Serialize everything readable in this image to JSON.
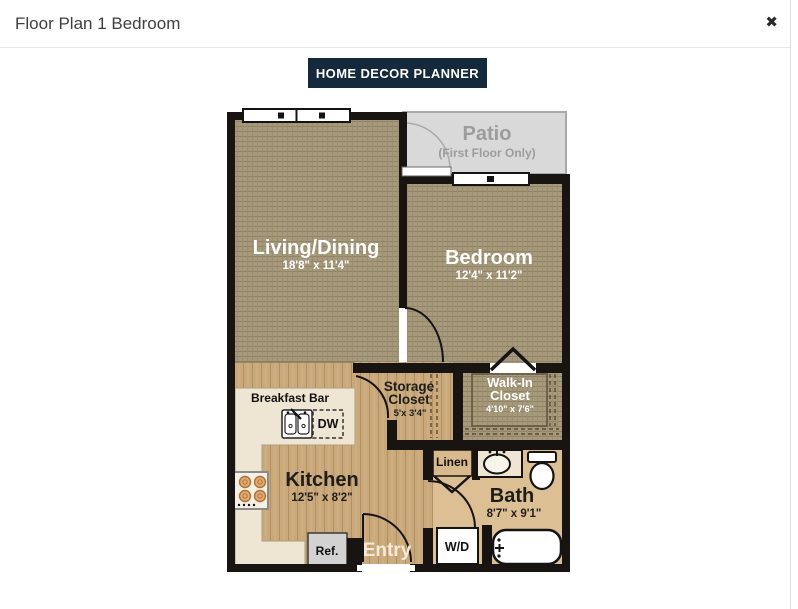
{
  "modal": {
    "title": "Floor Plan 1 Bedroom",
    "close_glyph": "✖",
    "planner_button": "HOME DECOR PLANNER"
  },
  "floorplan": {
    "patio": {
      "name": "Patio",
      "note": "(First Floor Only)"
    },
    "living": {
      "name": "Living/Dining",
      "dims": "18'8\" x 11'4\""
    },
    "bedroom": {
      "name": "Bedroom",
      "dims": "12'4\" x 11'2\""
    },
    "kitchen": {
      "name": "Kitchen",
      "dims": "12'5\" x 8'2\""
    },
    "bath": {
      "name": "Bath",
      "dims": "8'7\" x 9'1\""
    },
    "storage_closet": {
      "line1": "Storage",
      "line2": "Closet",
      "dims": "5'x 3'4\""
    },
    "walkin_closet": {
      "line1": "Walk-In",
      "line2": "Closet",
      "dims": "4'10\" x 7'6\""
    },
    "labels": {
      "breakfast_bar": "Breakfast Bar",
      "dishwasher": "DW",
      "refrigerator": "Ref.",
      "entry": "Entry",
      "linen": "Linen",
      "washer_dryer": "W/D"
    },
    "colors": {
      "wall": "#171412",
      "carpet": "#a69a7b",
      "wood": "#c9a87a",
      "bath_floor": "#dcbf93",
      "counter": "#eee6d2",
      "patio": "#d9d9d9",
      "accent_button": "#15293d"
    }
  }
}
